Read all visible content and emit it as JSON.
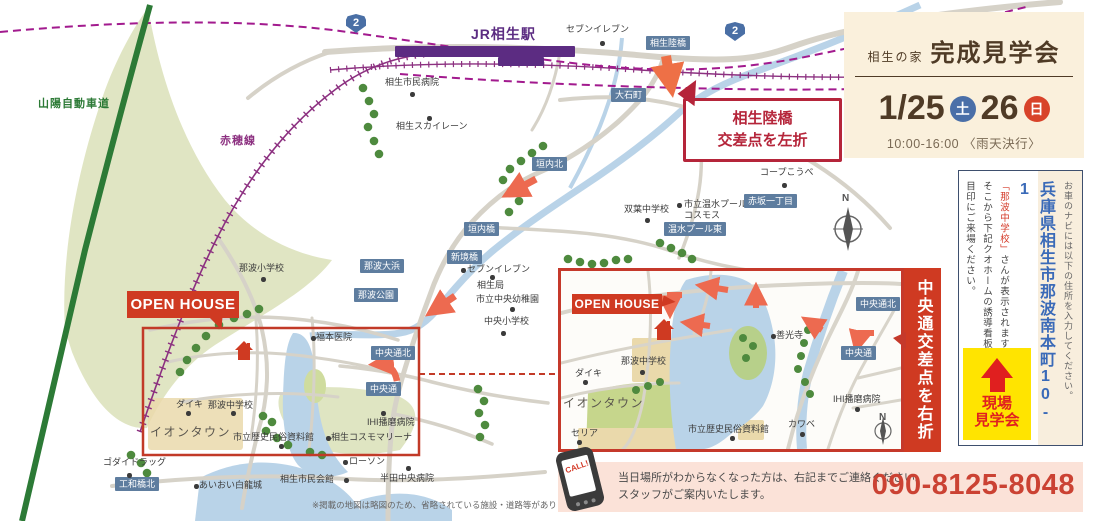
{
  "colors": {
    "accent_red": "#cf3a22",
    "callout_red": "#b5253a",
    "label_blue": "#5e7d9f",
    "rail_purple": "#8c3080",
    "station_purple": "#5c2c82",
    "shinkansen_magenta": "#a21a8e",
    "highway_green": "#2c7a36",
    "sat_blue": "#4a6fa8",
    "sun_red": "#d8432a",
    "address_blue": "#3a6ab8",
    "badge_yellow": "#ffe400",
    "phone_red": "#cb4233",
    "water_blue": "#b9d3e8",
    "tree_green": "#4e8a3e",
    "arrow_salmon": "#ed6a50"
  },
  "header": {
    "brand": "相生の家",
    "title": "完成見学会",
    "date_left": "1/25",
    "day_left": "土",
    "date_right": "26",
    "day_right": "日",
    "time": "10:00-16:00",
    "weather": "〈雨天決行〉"
  },
  "sidebar": {
    "nav_note": "お車のナビには以下の住所を入力してください。",
    "address": "兵庫県相生市那波南本町10-1",
    "landmark": "「那波中学校」",
    "landmark_rest": "さんが表示されます。",
    "guide2": "そこから下記クオホームの誘導看板を",
    "guide3": "目印にご来場ください。",
    "badge_line1": "現場",
    "badge_line2": "見学会"
  },
  "contact": {
    "line1": "当日場所がわからなくなった方は、右記までご連絡ください。",
    "line2": "スタッフがご案内いたします。",
    "phone": "090-8125-8048",
    "call": "CALL!"
  },
  "map": {
    "note": "※掲載の地図は略図のため、省略されている施設・道路等があります。",
    "open_house": "OPEN HOUSE",
    "callout_left": {
      "line1": "相生陸橋",
      "line2": "交差点を左折"
    },
    "inset_banner": "中央通交差点を右折",
    "labels": [
      {
        "t": "山陽自動車道",
        "x": 38,
        "y": 98,
        "k": "road"
      },
      {
        "t": "赤穂線",
        "x": 220,
        "y": 135,
        "k": "rail"
      },
      {
        "t": "JR相生駅",
        "x": 471,
        "y": 26,
        "k": "station"
      },
      {
        "t": "セブンイレブン",
        "x": 566,
        "y": 24,
        "k": "place",
        "d": [
          600,
          41
        ]
      },
      {
        "t": "相生陸橋",
        "x": 646,
        "y": 36,
        "k": "blue"
      },
      {
        "t": "大石町",
        "x": 611,
        "y": 88,
        "k": "blue"
      },
      {
        "t": "相生市民病院",
        "x": 385,
        "y": 77,
        "k": "place",
        "d": [
          410,
          92
        ]
      },
      {
        "t": "相生スカイレーン",
        "x": 396,
        "y": 121,
        "k": "place",
        "d": [
          427,
          116
        ]
      },
      {
        "t": "コープこうべ",
        "x": 760,
        "y": 167,
        "k": "place",
        "d": [
          782,
          183
        ]
      },
      {
        "t": "市立温水プール\nコスモス",
        "x": 684,
        "y": 199,
        "k": "place",
        "d": [
          677,
          203
        ]
      },
      {
        "t": "赤坂一丁目",
        "x": 744,
        "y": 194,
        "k": "blue"
      },
      {
        "t": "双葉中学校",
        "x": 624,
        "y": 204,
        "k": "place",
        "d": [
          645,
          218
        ]
      },
      {
        "t": "温水プール東",
        "x": 664,
        "y": 222,
        "k": "blue"
      },
      {
        "t": "垣内北",
        "x": 532,
        "y": 157,
        "k": "blue"
      },
      {
        "t": "垣内橋",
        "x": 464,
        "y": 222,
        "k": "blue"
      },
      {
        "t": "新境橋",
        "x": 447,
        "y": 250,
        "k": "blue"
      },
      {
        "t": "セブンイレブン",
        "x": 467,
        "y": 264,
        "k": "place",
        "d": [
          461,
          268
        ]
      },
      {
        "t": "相生局",
        "x": 477,
        "y": 280,
        "k": "place",
        "d": [
          490,
          275
        ]
      },
      {
        "t": "市立中央幼稚園",
        "x": 476,
        "y": 294,
        "k": "place",
        "d": [
          510,
          307
        ]
      },
      {
        "t": "中央小学校",
        "x": 484,
        "y": 316,
        "k": "place",
        "d": [
          501,
          331
        ]
      },
      {
        "t": "那波大浜",
        "x": 360,
        "y": 259,
        "k": "blue"
      },
      {
        "t": "那波公園",
        "x": 354,
        "y": 288,
        "k": "blue"
      },
      {
        "t": "那波小学校",
        "x": 239,
        "y": 263,
        "k": "place",
        "d": [
          261,
          277
        ]
      },
      {
        "t": "福本医院",
        "x": 316,
        "y": 332,
        "k": "place",
        "d": [
          311,
          336
        ]
      },
      {
        "t": "中央通北",
        "x": 371,
        "y": 346,
        "k": "blue"
      },
      {
        "t": "中央通",
        "x": 366,
        "y": 382,
        "k": "blue"
      },
      {
        "t": "ダイキ",
        "x": 176,
        "y": 399,
        "k": "place",
        "d": [
          186,
          411
        ]
      },
      {
        "t": "那波中学校",
        "x": 208,
        "y": 400,
        "k": "place",
        "d": [
          231,
          411
        ]
      },
      {
        "t": "イオンタウン",
        "x": 150,
        "y": 425,
        "k": "big"
      },
      {
        "t": "市立歴史民俗資料館",
        "x": 233,
        "y": 432,
        "k": "place",
        "d": [
          279,
          444
        ]
      },
      {
        "t": "相生コスモマリーナ",
        "x": 331,
        "y": 432,
        "k": "place",
        "d": [
          326,
          436
        ]
      },
      {
        "t": "IHI播磨病院",
        "x": 367,
        "y": 417,
        "k": "place",
        "d": [
          381,
          411
        ]
      },
      {
        "t": "ゴダイドラッグ",
        "x": 103,
        "y": 457,
        "k": "place",
        "d": [
          127,
          473
        ]
      },
      {
        "t": "工和橋北",
        "x": 115,
        "y": 477,
        "k": "blue"
      },
      {
        "t": "あいおい白龍城",
        "x": 199,
        "y": 480,
        "k": "place",
        "d": [
          194,
          484
        ]
      },
      {
        "t": "相生市民会館",
        "x": 280,
        "y": 474,
        "k": "place",
        "d": [
          344,
          478
        ]
      },
      {
        "t": "ローソン",
        "x": 349,
        "y": 456,
        "k": "place",
        "d": [
          343,
          460
        ]
      },
      {
        "t": "半田中央病院",
        "x": 380,
        "y": 473,
        "k": "place",
        "d": [
          406,
          466
        ]
      },
      {
        "t": "2",
        "x": 346,
        "y": 14,
        "k": "badge"
      },
      {
        "t": "2",
        "x": 725,
        "y": 22,
        "k": "badge"
      },
      {
        "t": "N",
        "x": 842,
        "y": 193,
        "k": "compass"
      },
      {
        "t": "那波中学校",
        "x": 621,
        "y": 356,
        "k": "place",
        "d": [
          640,
          370
        ]
      },
      {
        "t": "ダイキ",
        "x": 575,
        "y": 368,
        "k": "place",
        "d": [
          583,
          380
        ]
      },
      {
        "t": "イオンタウン",
        "x": 563,
        "y": 396,
        "k": "big"
      },
      {
        "t": "セリア",
        "x": 571,
        "y": 428,
        "k": "place",
        "d": [
          577,
          440
        ]
      },
      {
        "t": "市立歴史民俗資料館",
        "x": 688,
        "y": 424,
        "k": "place",
        "d": [
          730,
          436
        ]
      },
      {
        "t": "善光寺",
        "x": 776,
        "y": 330,
        "k": "place",
        "d": [
          771,
          334
        ]
      },
      {
        "t": "カワベ",
        "x": 788,
        "y": 419,
        "k": "place",
        "d": [
          800,
          432
        ]
      },
      {
        "t": "IHI播磨病院",
        "x": 833,
        "y": 394,
        "k": "place",
        "d": [
          855,
          407
        ]
      },
      {
        "t": "中央通北",
        "x": 856,
        "y": 297,
        "k": "blue"
      },
      {
        "t": "中央通",
        "x": 841,
        "y": 346,
        "k": "blue"
      },
      {
        "t": "N",
        "x": 879,
        "y": 412,
        "k": "compass"
      }
    ]
  }
}
